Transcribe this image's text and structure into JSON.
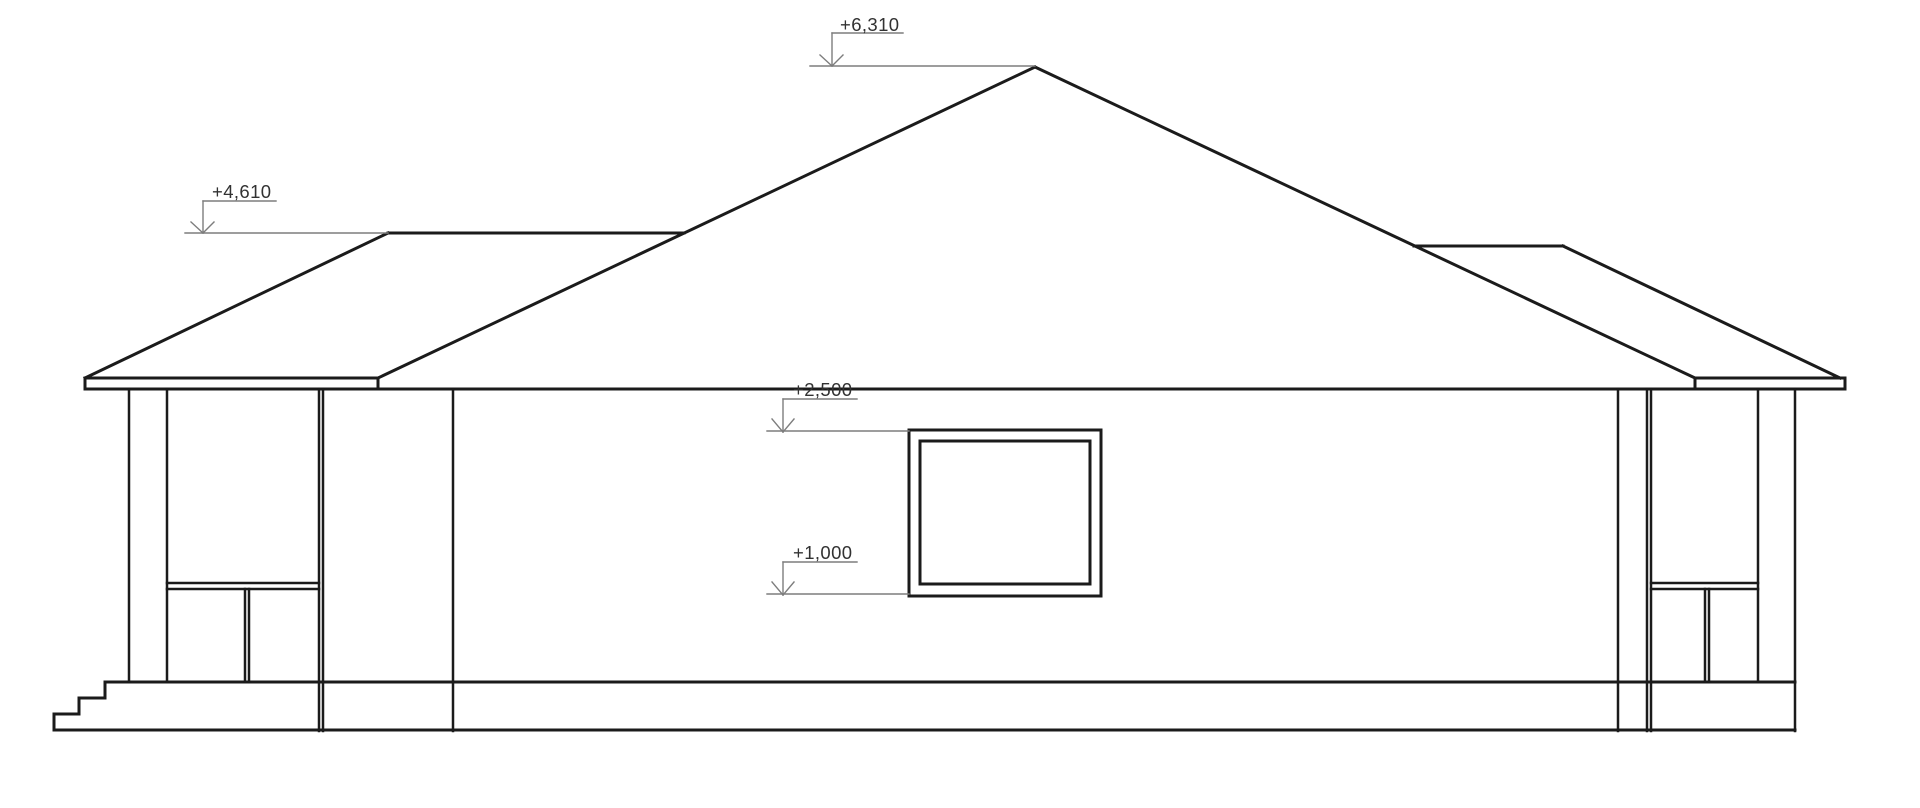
{
  "drawing": {
    "type": "architectural_side_elevation",
    "description": "Single-storey house side elevation with hip roof, two corner porches with columns and railings, entry steps and one window",
    "background": "#ffffff",
    "colors": {
      "building_line": "#1b1b1b",
      "marker_line": "#7d7d7d",
      "label_text": "#323232"
    },
    "stroke_widths": {
      "thick": 3,
      "medium": 2.5,
      "thin": 1.4
    },
    "elevation_markers": [
      {
        "label": "+6,310",
        "lines": [
          [
            832,
            33,
            903,
            33
          ],
          [
            832,
            33,
            832,
            66
          ],
          [
            820,
            55,
            832,
            66
          ],
          [
            843,
            55,
            832,
            66
          ],
          [
            810,
            66,
            1035,
            66
          ]
        ]
      },
      {
        "label": "+4,610",
        "lines": [
          [
            203,
            201,
            276,
            201
          ],
          [
            203,
            201,
            203,
            233
          ],
          [
            191,
            222,
            203,
            233
          ],
          [
            214,
            222,
            203,
            233
          ],
          [
            185,
            233,
            388,
            233
          ]
        ]
      },
      {
        "label": "+2,500",
        "lines": [
          [
            783,
            399,
            857,
            399
          ],
          [
            783,
            399,
            783,
            432
          ],
          [
            772,
            419,
            783,
            432
          ],
          [
            794,
            419,
            783,
            432
          ],
          [
            767,
            431,
            909,
            431
          ]
        ]
      },
      {
        "label": "+1,000",
        "lines": [
          [
            783,
            562,
            857,
            562
          ],
          [
            783,
            562,
            783,
            595
          ],
          [
            772,
            582,
            783,
            595
          ],
          [
            794,
            582,
            783,
            595
          ],
          [
            767,
            594,
            909,
            594
          ]
        ]
      }
    ],
    "line_groups": [
      {
        "name": "main-roof-slopes",
        "weight": "thick",
        "segments": [
          [
            1035,
            67,
            378,
            378
          ],
          [
            1035,
            67,
            1695,
            378
          ]
        ]
      },
      {
        "name": "left-wing-roof",
        "weight": "thick",
        "segments": [
          [
            85,
            378,
            388,
            233
          ],
          [
            388,
            233,
            684,
            233
          ]
        ]
      },
      {
        "name": "right-wing-roof",
        "weight": "thick",
        "segments": [
          [
            1414,
            246,
            1563,
            246
          ],
          [
            1563,
            246,
            1840,
            378
          ]
        ]
      },
      {
        "name": "left-fascia-board",
        "weight": "thick",
        "segments": [
          [
            85,
            378,
            378,
            378
          ],
          [
            85,
            378,
            85,
            389
          ],
          [
            378,
            378,
            378,
            389
          ]
        ]
      },
      {
        "name": "right-fascia-board",
        "weight": "thick",
        "segments": [
          [
            1695,
            378,
            1845,
            378
          ],
          [
            1695,
            378,
            1695,
            389
          ],
          [
            1845,
            378,
            1845,
            389
          ]
        ]
      },
      {
        "name": "eave-wall-top-line",
        "weight": "thick",
        "segments": [
          [
            85,
            389,
            1845,
            389
          ]
        ]
      },
      {
        "name": "window-outer-frame",
        "weight": "thick",
        "segments": [
          [
            909,
            430,
            1101,
            430
          ],
          [
            1101,
            430,
            1101,
            596
          ],
          [
            909,
            596,
            1101,
            596
          ],
          [
            909,
            430,
            909,
            596
          ]
        ]
      },
      {
        "name": "window-inner-frame",
        "weight": "thick",
        "segments": [
          [
            920,
            441,
            1090,
            441
          ],
          [
            1090,
            441,
            1090,
            584
          ],
          [
            920,
            584,
            1090,
            584
          ],
          [
            920,
            441,
            920,
            584
          ]
        ]
      },
      {
        "name": "porch-floor-line",
        "weight": "thick",
        "segments": [
          [
            105,
            682,
            1795,
            682
          ]
        ]
      },
      {
        "name": "ground-line",
        "weight": "thick",
        "segments": [
          [
            54,
            730,
            1795,
            730
          ]
        ]
      },
      {
        "name": "entry-steps",
        "weight": "thick",
        "segments": [
          [
            54,
            714,
            54,
            730
          ],
          [
            54,
            714,
            79,
            714
          ],
          [
            79,
            698,
            79,
            714
          ],
          [
            79,
            698,
            105,
            698
          ],
          [
            105,
            682,
            105,
            698
          ]
        ]
      },
      {
        "name": "left-porch-columns",
        "weight": "medium",
        "segments": [
          [
            129,
            389,
            129,
            682
          ],
          [
            167,
            389,
            167,
            682
          ],
          [
            319,
            389,
            319,
            731
          ],
          [
            323,
            389,
            323,
            731
          ],
          [
            453,
            389,
            453,
            731
          ]
        ]
      },
      {
        "name": "left-porch-railing",
        "weight": "medium",
        "segments": [
          [
            167,
            583,
            319,
            583
          ],
          [
            167,
            589,
            319,
            589
          ],
          [
            245,
            589,
            245,
            682
          ],
          [
            249,
            589,
            249,
            682
          ]
        ]
      },
      {
        "name": "right-porch-columns",
        "weight": "medium",
        "segments": [
          [
            1618,
            389,
            1618,
            731
          ],
          [
            1647,
            389,
            1647,
            731
          ],
          [
            1651,
            389,
            1651,
            731
          ],
          [
            1758,
            389,
            1758,
            682
          ],
          [
            1795,
            389,
            1795,
            731
          ]
        ]
      },
      {
        "name": "right-porch-railing",
        "weight": "medium",
        "segments": [
          [
            1651,
            583,
            1758,
            583
          ],
          [
            1651,
            589,
            1758,
            589
          ],
          [
            1705,
            589,
            1705,
            682
          ],
          [
            1709,
            589,
            1709,
            682
          ]
        ]
      }
    ]
  }
}
